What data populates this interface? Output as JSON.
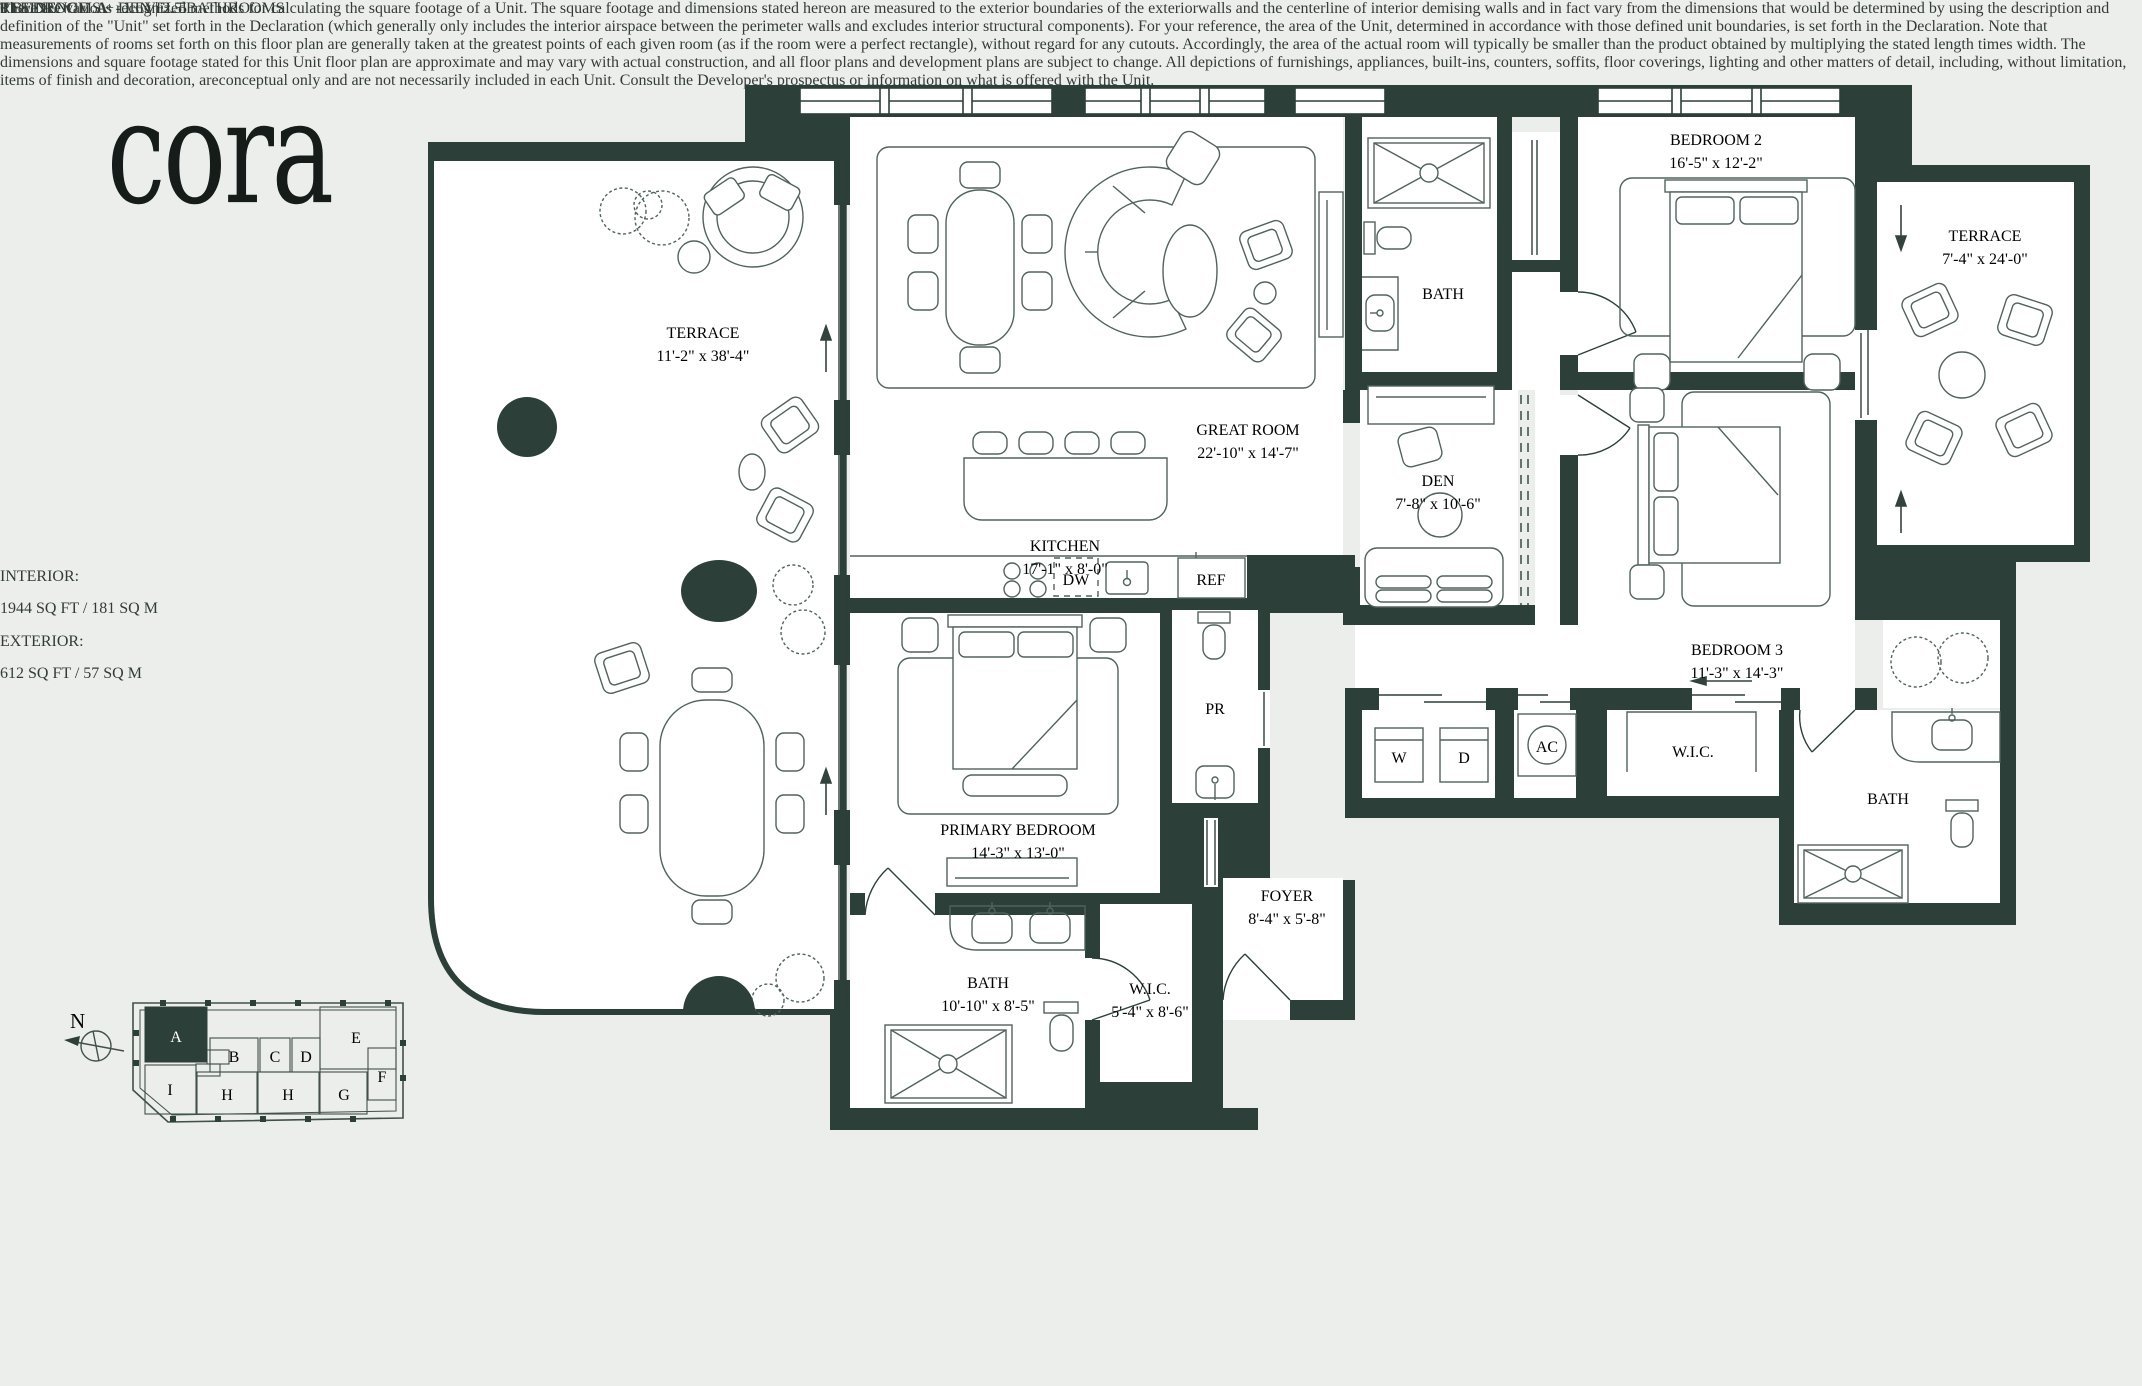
{
  "brand": {
    "logo": "cora"
  },
  "sidebar": {
    "residence_label": "RESIDENCE",
    "residence_unit": "A",
    "residence_rest": "-  LEVEL 5",
    "features": "3 BEDROOMS + DEN | 3.5 BATHROOMS",
    "interior_label": "INTERIOR:",
    "interior_value": "1944 SQ FT / 181 SQ M",
    "exterior_label": "EXTERIOR:",
    "exterior_value": "612 SQ FT / 57 SQ M",
    "line_label": "01 LINE"
  },
  "keyplan": {
    "north": "N",
    "units": [
      "A",
      "B",
      "C",
      "D",
      "E",
      "F",
      "G",
      "H",
      "H",
      "I"
    ],
    "highlighted_unit": "A"
  },
  "rooms": {
    "terrace_left": {
      "name": "TERRACE",
      "dims": "11'-2\" x 38'-4\""
    },
    "great_room": {
      "name": "GREAT ROOM",
      "dims": "22'-10\" x 14'-7\""
    },
    "kitchen": {
      "name": "KITCHEN",
      "dims": "17'-1\" x 8'-0\""
    },
    "bath_2": {
      "name": "BATH"
    },
    "bedroom_2": {
      "name": "BEDROOM 2",
      "dims": "16'-5\" x 12'-2\""
    },
    "terrace_right": {
      "name": "TERRACE",
      "dims": "7'-4\" x 24'-0\""
    },
    "den": {
      "name": "DEN",
      "dims": "7'-8\" x 10'-6\""
    },
    "bedroom_3": {
      "name": "BEDROOM 3",
      "dims": "11'-3\" x 14'-3\""
    },
    "wic_3": {
      "name": "W.I.C."
    },
    "bath_3": {
      "name": "BATH"
    },
    "primary_bedroom": {
      "name": "PRIMARY BEDROOM",
      "dims": "14'-3\" x 13'-0\""
    },
    "primary_bath": {
      "name": "BATH",
      "dims": "10'-10\" x 8'-5\""
    },
    "wic_primary": {
      "name": "W.I.C.",
      "dims": "5'-4\" x 8'-6\""
    },
    "foyer": {
      "name": "FOYER",
      "dims": "8'-4\" x 5'-8\""
    },
    "powder_room": {
      "name": "PR"
    }
  },
  "appliances": {
    "dishwasher": "DW",
    "refrigerator": "REF",
    "washer": "W",
    "dryer": "D",
    "ac": "AC"
  },
  "colors": {
    "wall": "#2d3f39",
    "background": "#eceeec",
    "linework": "#52625c"
  },
  "disclaimer": "There are various recognized methods for calculating the square footage of a Unit. The square footage and dimensions stated hereon are measured to the exterior boundaries of the exteriorwalls and the centerline of interior demising walls and in fact vary from the dimensions that would be determined by using the description and definition of the \"Unit\" set forth in the Declaration (which generally only includes the interior airspace between the perimeter walls and excludes interior structural components). For your reference, the area of the Unit, determined in accordance with those defined unit boundaries, is set forth in the Declaration. Note that measurements of rooms set forth on this floor plan are generally taken at the greatest points of each given room (as if the room were a perfect rectangle), without regard for any cutouts. Accordingly, the area of the actual room will typically be smaller than the product obtained by multiplying the stated length times width. The dimensions and square footage stated for this Unit floor plan are approximate and may vary with actual construction, and all floor plans and development plans are subject to change. All depictions of furnishings, appliances, built-ins, counters, soffits, floor coverings, lighting and other matters of detail, including, without limitation, items of finish and decoration, areconceptual only and are not necessarily included in each Unit. Consult the Developer's prospectus or information on what is offered with the Unit."
}
